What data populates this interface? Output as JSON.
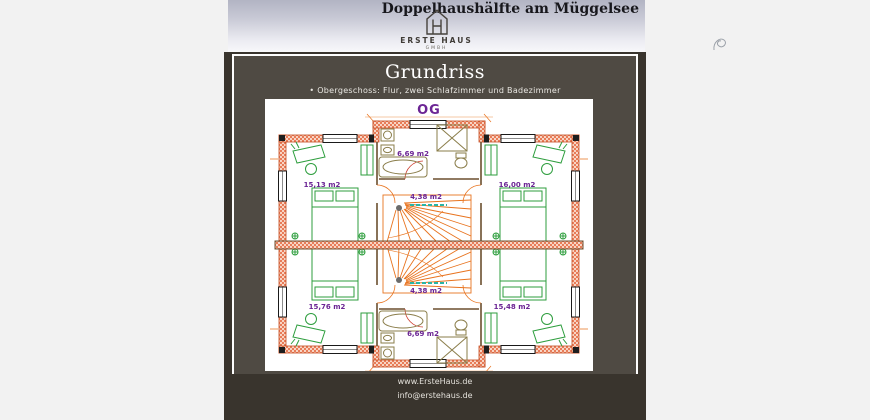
{
  "header": {
    "title": "Doppelhaushälfte am Müggelsee",
    "logo_name": "ERSTE HAUS",
    "logo_suffix": "GMBH"
  },
  "card": {
    "title": "Grundriss",
    "subtitle": "• Obergeschoss: Flur, zwei Schlafzimmer und Badezimmer"
  },
  "plan": {
    "floor_label": "OG",
    "labels": {
      "top_left_room": "15,13 m2",
      "top_bath": "6,69 m2",
      "top_right_room": "16,00 m2",
      "top_hall": "4,38 m2",
      "bottom_hall": "4,38 m2",
      "bottom_left_room": "15,76 m2",
      "bottom_right_room": "15,48 m2",
      "bottom_bath": "6,69 m2"
    },
    "colors": {
      "walls": "#e2572b",
      "furniture": "#2e9e3e",
      "stairs": "#e8731e",
      "area_labels": "#6b2494",
      "bath_fixtures": "#8a7d4a",
      "stair_edge_dash": "#2ab5a5"
    }
  },
  "footer": {
    "website": "www.ErsteHaus.de",
    "email": "info@erstehaus.de"
  }
}
